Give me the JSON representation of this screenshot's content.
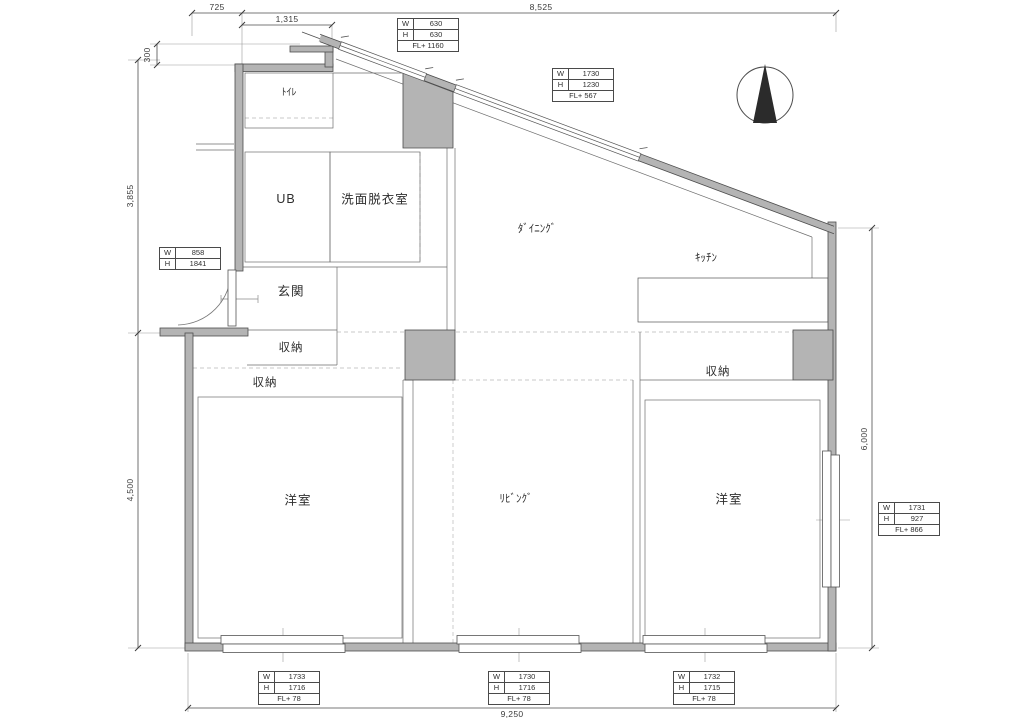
{
  "rooms": {
    "toilet": "ﾄｲﾚ",
    "unit_bath": "UB",
    "washroom": "洗面脱衣室",
    "entrance": "玄関",
    "storage_entrance": "収納",
    "storage_left": "収納",
    "storage_right": "収納",
    "dining": "ﾀﾞｲﾆﾝｸﾞ",
    "kitchen": "ｷｯﾁﾝ",
    "living": "ﾘﾋﾞﾝｸﾞ",
    "bedroom_left": "洋室",
    "bedroom_right": "洋室"
  },
  "dimensions": {
    "top_left": "725",
    "top_inner": "1,315",
    "top_main": "8,525",
    "left_offset": "300",
    "left_upper": "3,855",
    "left_lower": "4,500",
    "right_height": "6,000",
    "bottom_width": "9,250"
  },
  "openings": {
    "w_label": "W",
    "h_label": "H",
    "slant_small": {
      "w": "630",
      "h": "630",
      "fl": "FL+ 1160"
    },
    "slant_large": {
      "w": "1730",
      "h": "1230",
      "fl": "FL+ 567"
    },
    "entrance_door": {
      "w": "858",
      "h": "1841"
    },
    "right_window": {
      "w": "1731",
      "h": "927",
      "fl": "FL+ 866"
    },
    "bottom_left_window": {
      "w": "1733",
      "h": "1716",
      "fl": "FL+ 78"
    },
    "bottom_center_window": {
      "w": "1730",
      "h": "1716",
      "fl": "FL+ 78"
    },
    "bottom_right_window": {
      "w": "1732",
      "h": "1715",
      "fl": "FL+ 78"
    }
  }
}
